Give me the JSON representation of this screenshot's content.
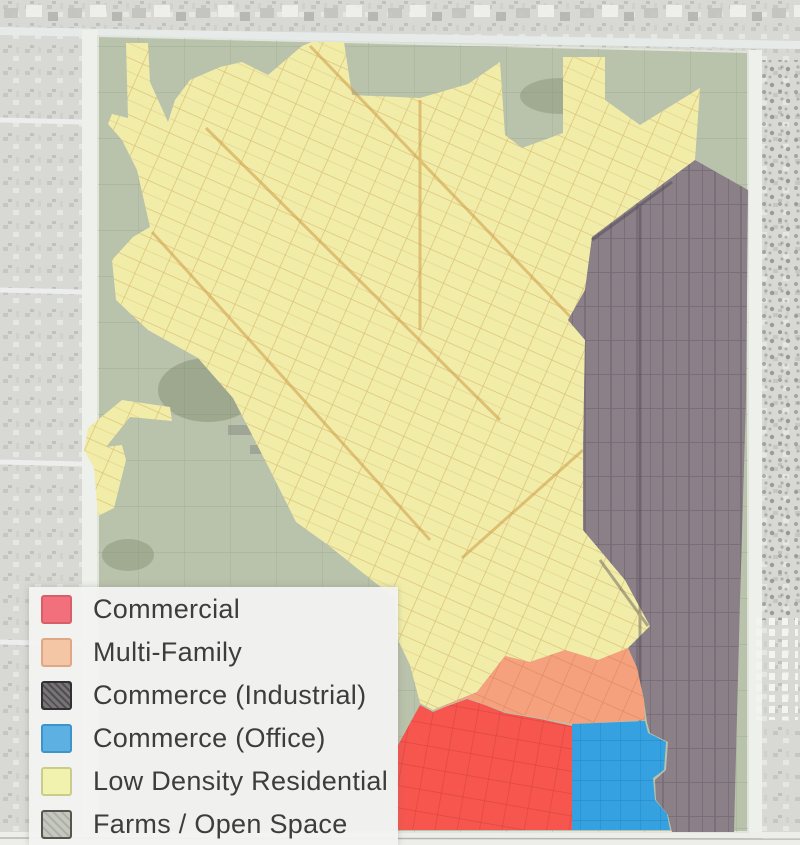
{
  "legend": {
    "items": [
      {
        "label": "Commercial",
        "color": "#f2707b",
        "border": "#d85f69"
      },
      {
        "label": "Multi-Family",
        "color": "#f5c6a6",
        "border": "#dfa885"
      },
      {
        "label": "Commerce (Industrial)",
        "color": "#6f6c6f",
        "border": "#323032"
      },
      {
        "label": "Commerce (Office)",
        "color": "#5cb0e2",
        "border": "#3d93cc"
      },
      {
        "label": "Low Density Residential",
        "color": "#f0f2ad",
        "border": "#c9cc8d"
      },
      {
        "label": "Farms / Open Space",
        "color": "#c2c5bc",
        "border": "#565550"
      }
    ]
  },
  "map_colors": {
    "commercial": "#f6564e",
    "multi_family": "#f5a17d",
    "industrial": "#8b7f88",
    "office": "#35a1e0",
    "low_density_residential": "#f1eda9",
    "farms_open_space": "#b9c2ab",
    "aerial_base": "#d8d9d4",
    "road_white": "#eef0ec"
  }
}
